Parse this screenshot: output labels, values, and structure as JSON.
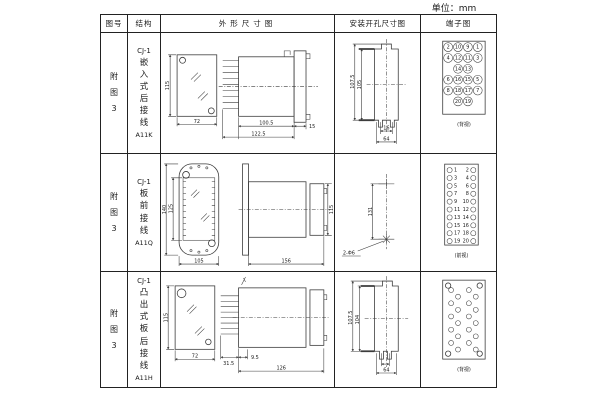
{
  "unit_label": "单位：mm",
  "header": {
    "fig_no": "图号",
    "structure": "结构",
    "outline": "外形尺寸图",
    "install": "安装开孔尺寸图",
    "terminal": "端子图"
  },
  "rows": [
    {
      "fig_no": "附图3",
      "model_prefix": "CJ-1",
      "structure_name": "嵌入式后接线",
      "model": "A11K",
      "outline": {
        "front_h": "115",
        "front_w": "72",
        "body_len": "100.5",
        "total_len": "122.5",
        "flange_t": "15"
      },
      "install": {
        "outer_h": "107.5",
        "inner_h": "105",
        "slot_span": "16",
        "hole_span": "64"
      },
      "terminal": {
        "view": "(背视)",
        "grid": [
          [
            "2",
            "10",
            "9",
            "1"
          ],
          [
            "4",
            "12",
            "11",
            "3"
          ],
          [
            "",
            "14",
            "13",
            ""
          ],
          [
            "6",
            "16",
            "15",
            "5"
          ],
          [
            "8",
            "18",
            "17",
            "7"
          ],
          [
            "",
            "20",
            "19",
            ""
          ]
        ]
      }
    },
    {
      "fig_no": "附图3",
      "model_prefix": "CJ-1",
      "structure_name": "板前接线",
      "model": "A11Q",
      "outline": {
        "front_outer_h": "140",
        "front_inner_h": "125",
        "front_w": "105",
        "depth": "156",
        "side_h": "115"
      },
      "install": {
        "hole_dist": "131",
        "hole_note": "2-Φ6"
      },
      "terminal": {
        "view": "(前视)",
        "left": [
          "1",
          "3",
          "5",
          "7",
          "9",
          "11",
          "13",
          "15",
          "17",
          "19"
        ],
        "right": [
          "2",
          "4",
          "6",
          "8",
          "10",
          "12",
          "14",
          "16",
          "18",
          "20"
        ]
      }
    },
    {
      "fig_no": "附图3",
      "model_prefix": "CJ-1",
      "structure_name": "凸出式板后接线",
      "model": "A11H",
      "outline": {
        "front_h": "115",
        "front_w": "72",
        "pin_len": "31.5",
        "gap": "9.5",
        "body_len": "126"
      },
      "install": {
        "outer_h": "107.5",
        "inner_h": "104",
        "hole_span": "64"
      },
      "terminal": {
        "view": "(背视)"
      }
    }
  ]
}
